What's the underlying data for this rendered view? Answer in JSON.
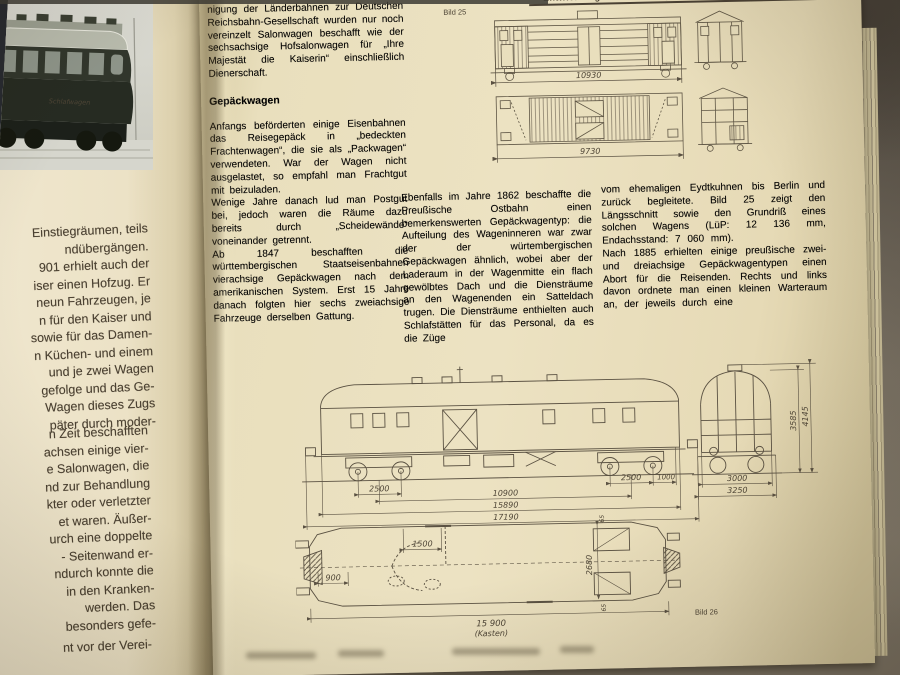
{
  "colors": {
    "paper": "#e9dfbd",
    "ink": "#473d2d",
    "line": "#5a5142",
    "background": "#756d60"
  },
  "page_header": {
    "title": "Entwicklung der Reisezugwagen",
    "page_number": "29"
  },
  "left_page": {
    "photo": {
      "car_lettering": "Schlafwagen"
    },
    "lines_a": [
      "Einstiegräumen,  teils",
      "ndübergängen.",
      "901  erhielt  auch  der",
      "iser  einen  Hofzug.  Er",
      "neun  Fahrzeugen,  je",
      "n  für  den  Kaiser  und",
      "sowie  für  das  Damen-",
      "n  Küchen-  und  einem",
      "und  je  zwei  Wagen",
      "gefolge  und  das  Ge-",
      "Wagen  dieses  Zugs",
      "päter  durch  moder-"
    ],
    "lines_b": [
      "n  Zeit  beschafften",
      "achsen  einige  vier-",
      "e  Salonwagen,  die",
      "nd  zur  Behandlung",
      "kter  oder  verletzter",
      "et  waren.  Äußer-",
      "urch  eine  doppelte",
      "-  Seitenwand  er-",
      "ndurch  konnte  die",
      "in  den  Kranken-",
      "werden.   Das",
      "besonders  gefe-"
    ],
    "line_c": "nt  vor  der  Verei-"
  },
  "columns": {
    "col1_intro": "nigung der Länderbahnen zur Deutschen Reichsbahn-Gesellschaft wurden nur noch vereinzelt Salonwagen beschafft wie der sechsachsige Hofsalonwagen für „Ihre Majestät die Kaiserin“ einschließlich Dienerschaft.",
    "heading": "Gepäckwagen",
    "col1_p1": "Anfangs beförderten einige Eisenbahnen das Reisegepäck in „bedeckten Frachtenwagen“, die sie als „Packwagen“ verwendeten. War der Wagen nicht ausgelastet, so empfahl man Frachtgut mit beizuladen.",
    "col1_p2": "Wenige Jahre danach lud man Postgut bei, jedoch waren die Räume dazu bereits durch „Scheidewände“ voneinander getrennt.",
    "col1_p3": "Ab 1847 beschafften die württembergischen Staatseisenbahnen vierachsige Gepäckwagen nach dem amerikanischen System. Erst 15 Jahre danach folgten hier sechs zweiachsige Fahrzeuge derselben Gattung.",
    "col2_p1": "Ebenfalls im Jahre 1862 beschaffte die Preußische Ostbahn einen bemerkenswerten Gepäckwagentyp: die Aufteilung des Wageninneren war zwar der der würtembergischen Gepäckwagen ähnlich, wobei aber der Laderaum in der Wagenmitte ein flach gewölbtes Dach und die Diensträume an den Wagenenden ein Satteldach trugen. Die Diensträume enthielten auch Schlafstätten für das Personal, da es die Züge",
    "col3_p1": "vom ehemaligen Eydtkuhnen bis Berlin und zurück begleitete. Bild 25 zeigt den Längsschnitt sowie den Grundriß eines solchen Wagens (LüP: 12 136 mm, Endachsstand: 7 060 mm).",
    "col3_p2": "Nach 1885 erhielten einige preußische zwei- und dreiachsige Gepäckwagentypen einen Abort für die Reisenden. Rechts und links davon ordnete man einen kleinen Warteraum an, der jeweils durch eine"
  },
  "figure25": {
    "label": "Bild 25",
    "dim_length_elevation": "10930",
    "dim_length_plan": "9730"
  },
  "figure26": {
    "label": "Bild 26",
    "dims": {
      "bogie_left": "2500",
      "center": "10900",
      "bogie_right": "2500",
      "overhang": "1000",
      "length_body": "15890",
      "length_buffers": "17190",
      "width_body": "3000",
      "width_overall": "3250",
      "height_roof": "3585",
      "height_total": "4145",
      "plan_door": "1500",
      "plan_end": "900",
      "plan_width": "2680",
      "wall_top": "65",
      "wall_bottom": "65",
      "plan_length": "15 900",
      "plan_length_note": "(Kasten)"
    }
  }
}
